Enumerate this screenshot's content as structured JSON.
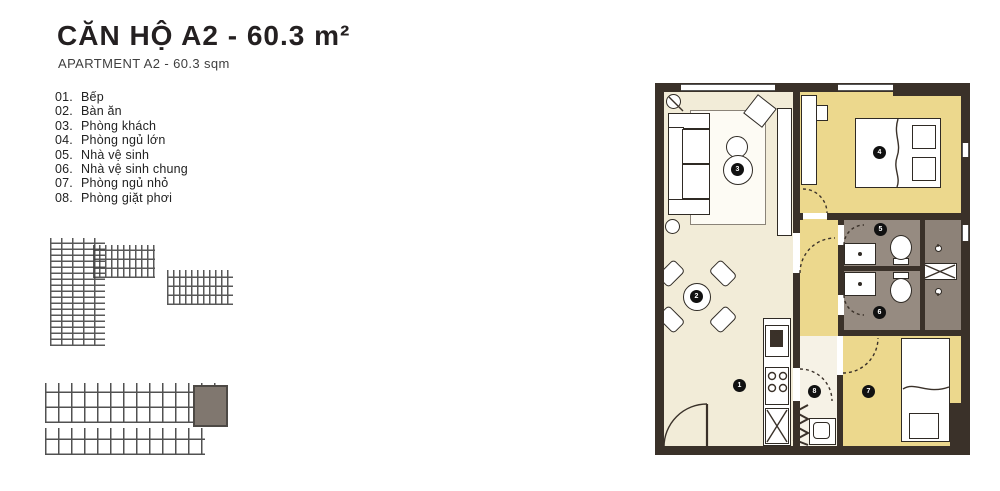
{
  "header": {
    "title": "CĂN HỘ A2 - 60.3 m²",
    "subtitle": "APARTMENT A2 - 60.3 sqm"
  },
  "legend": {
    "items": [
      {
        "num": "01.",
        "label": "Bếp"
      },
      {
        "num": "02.",
        "label": "Bàn ăn"
      },
      {
        "num": "03.",
        "label": "Phòng khách"
      },
      {
        "num": "04.",
        "label": "Phòng ngủ lớn"
      },
      {
        "num": "05.",
        "label": "Nhà vệ sinh"
      },
      {
        "num": "06.",
        "label": "Nhà vệ sinh chung"
      },
      {
        "num": "07.",
        "label": "Phòng ngủ nhỏ"
      },
      {
        "num": "08.",
        "label": "Phòng giặt phơi"
      }
    ]
  },
  "plan": {
    "markers": [
      {
        "n": "1",
        "room": "Bếp"
      },
      {
        "n": "2",
        "room": "Bàn ăn"
      },
      {
        "n": "3",
        "room": "Phòng khách"
      },
      {
        "n": "4",
        "room": "Phòng ngủ lớn"
      },
      {
        "n": "5",
        "room": "Nhà vệ sinh"
      },
      {
        "n": "6",
        "room": "Nhà vệ sinh chung"
      },
      {
        "n": "7",
        "room": "Phòng ngủ nhỏ"
      },
      {
        "n": "8",
        "room": "Phòng giặt phơi"
      }
    ],
    "colors": {
      "wall": "#3a3129",
      "living_floor": "#f2ecd8",
      "bedroom_floor": "#ecd88d",
      "bathroom_floor": "#968b81",
      "laundry_floor": "#8d8278",
      "keyplan_highlight": "#6b6056"
    }
  }
}
